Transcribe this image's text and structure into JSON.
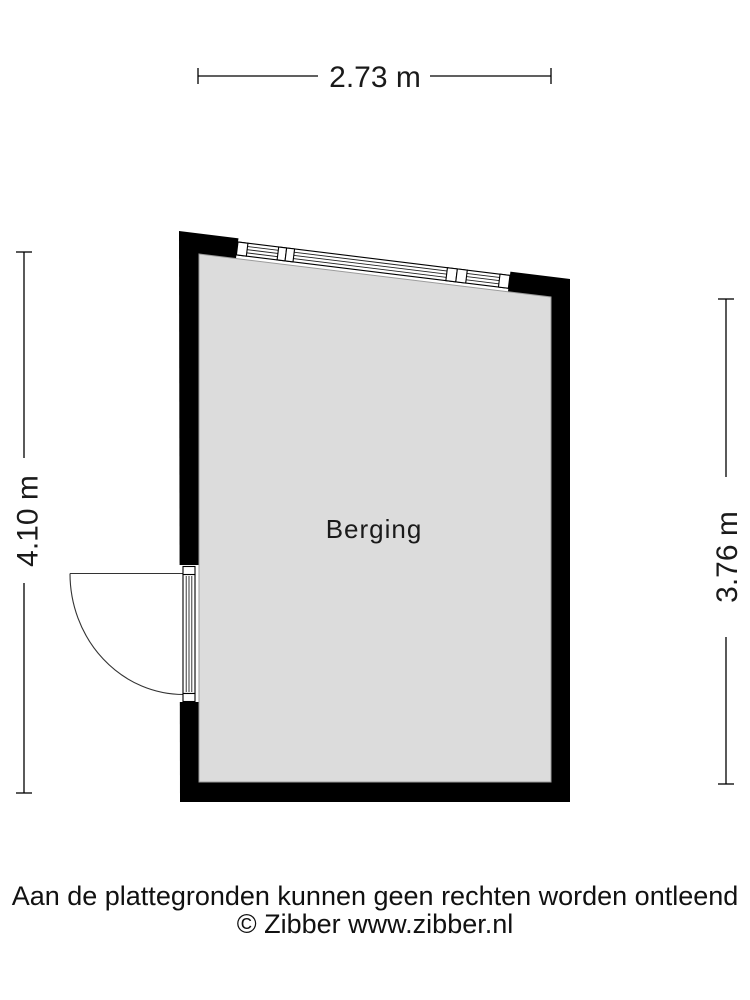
{
  "floorplan": {
    "room_label": "Berging",
    "dimensions": {
      "top": "2.73 m",
      "left": "4.10 m",
      "right": "3.76 m"
    },
    "colors": {
      "wall": "#000000",
      "floor": "#dcdcdc",
      "floor_outline": "#9b9b9b",
      "line": "#000000"
    }
  },
  "footer": {
    "disclaimer": "Aan de plattegronden kunnen geen rechten worden ontleend",
    "copyright": "© Zibber www.zibber.nl"
  }
}
